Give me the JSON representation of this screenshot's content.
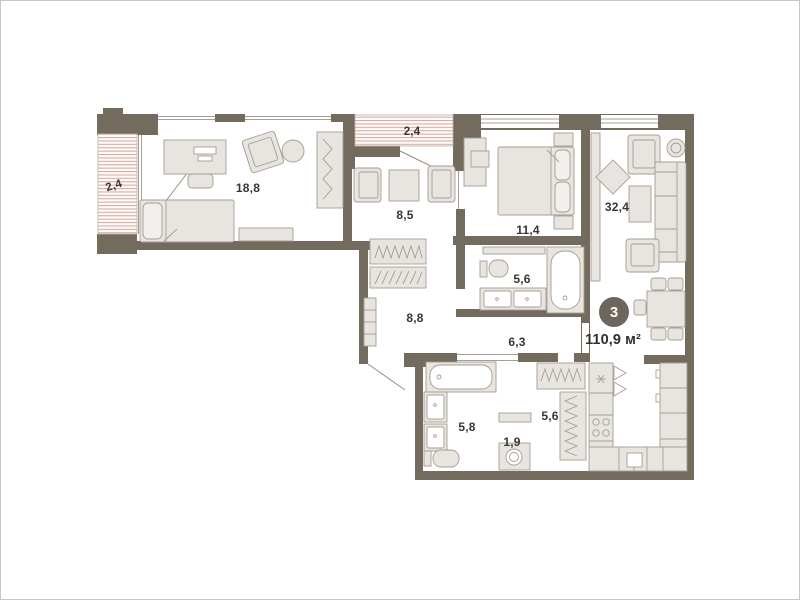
{
  "plan": {
    "title": "apartment-floor-plan",
    "badge": {
      "number": "3",
      "area": "110,9 м²"
    },
    "rooms": [
      {
        "id": "balcony-left",
        "label": "2,4"
      },
      {
        "id": "bedroom-large",
        "label": "18,8"
      },
      {
        "id": "balcony-top",
        "label": "2,4"
      },
      {
        "id": "lounge",
        "label": "8,5"
      },
      {
        "id": "bedroom-second",
        "label": "11,4"
      },
      {
        "id": "living-room",
        "label": "32,4"
      },
      {
        "id": "bathroom-main",
        "label": "5,6"
      },
      {
        "id": "corridor",
        "label": "8,8"
      },
      {
        "id": "hallway",
        "label": "6,3"
      },
      {
        "id": "bathroom-second",
        "label": "5,8"
      },
      {
        "id": "laundry",
        "label": "1,9"
      },
      {
        "id": "walk-in-closet",
        "label": "5,6"
      }
    ],
    "colors": {
      "wall": "#746b5f",
      "stripe": "#d9aba3",
      "furnFill": "#e8e5e0",
      "furnStroke": "#a49d92",
      "badgeBg": "#6e665c",
      "labelColor": "#3a362f"
    }
  }
}
